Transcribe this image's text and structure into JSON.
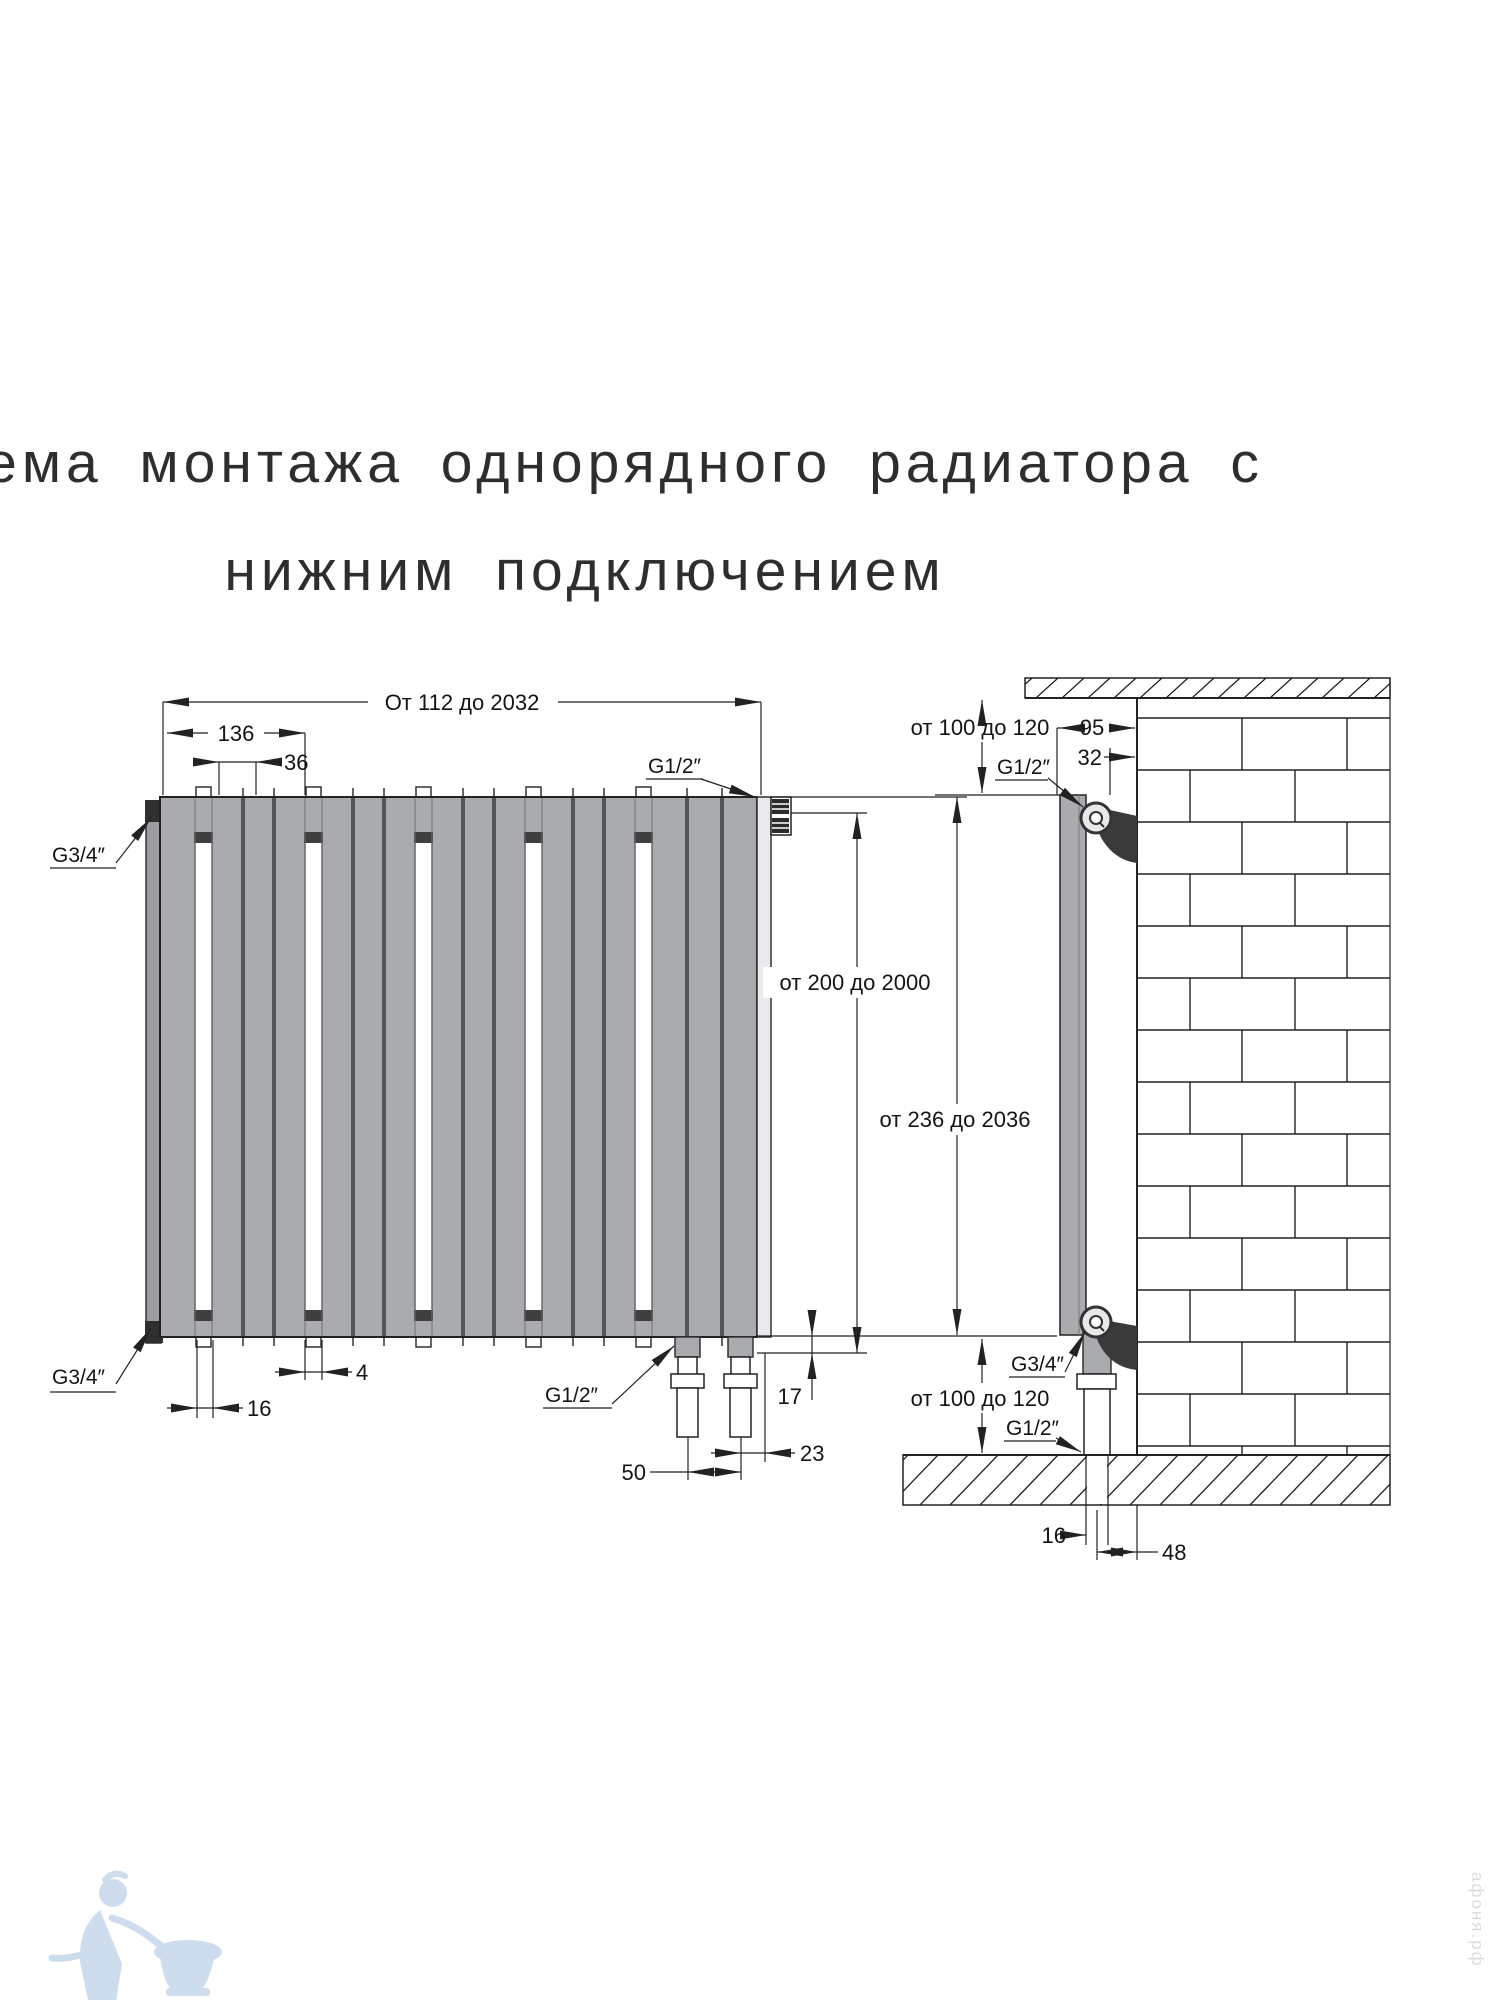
{
  "title": {
    "line1": "Схема монтажа однорядного радиатора с",
    "line2": "нижним подключением"
  },
  "front_view": {
    "dim_overall_width": "От 112 до 2032",
    "dim_group_width": "136",
    "dim_panel_pitch": "36",
    "dim_panel_gap": "4",
    "dim_gap_width": "16",
    "dim_stub_height": "17",
    "dim_edge_offset": "23",
    "dim_pipe_spacing": "50",
    "dim_height_body": "от 200 до 2000",
    "dim_height_total": "от 236 до 2036",
    "conn_top_left": "G3/4″",
    "conn_bottom_left": "G3/4″",
    "conn_top_right": "G1/2″",
    "conn_bottom_pipes": "G1/2″"
  },
  "side_view": {
    "dim_top_clearance": "от 100 до 120",
    "dim_wall_to_front": "95",
    "dim_wall_to_valve": "32",
    "conn_top_valve": "G1/2″",
    "conn_bottom_union": "G3/4″",
    "conn_bottom_pipe": "G1/2″",
    "dim_bottom_clearance": "от 100 до 120",
    "dim_pipe_size": "16",
    "dim_wall_to_pipe": "48"
  },
  "watermark": {
    "brand_vertical": "афоня.рф"
  },
  "colors": {
    "panel_gray": "#a9abae",
    "dark_metal": "#3a3a3a",
    "line": "#222222",
    "watermark_blue": "#c6d8eb"
  }
}
